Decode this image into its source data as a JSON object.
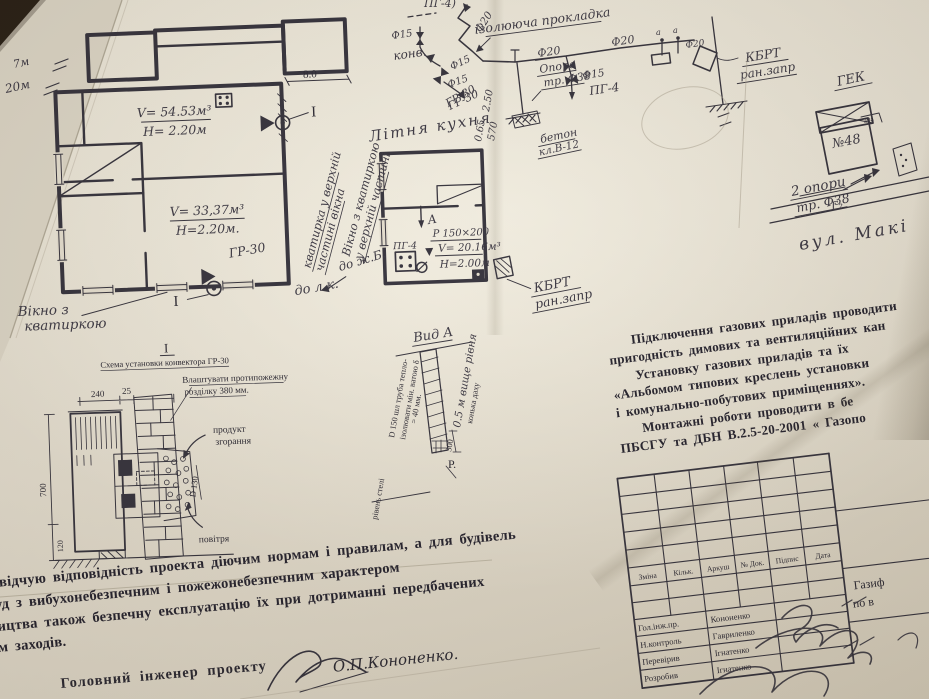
{
  "margin": {
    "note_7m": "7м",
    "note_20m": "20м"
  },
  "floor_plan": {
    "dim_8": "8.0",
    "room1_v": "V= 54.53м³",
    "room1_h": "Н= 2.20м",
    "room2_v": "V= 33,37м³",
    "room2_h": "Н=2.20м.",
    "gr30": "ГР-30",
    "section_right": "I",
    "section_bottom": "I",
    "window_note_1": "Вікно з",
    "window_note_2": "кватиркою",
    "rot_note_1a": "кватирка у верхній",
    "rot_note_1b": "частині вікна",
    "to_lk": "до л.к."
  },
  "kitchen": {
    "title": "Літня кухня",
    "gr30": "ГР-30",
    "rot_note_a": "Вікно з кватиркою",
    "rot_note_b": "у верхній частині",
    "to_zb": "до ж.Б.",
    "pg4": "ПГ-4",
    "view_a": "А",
    "vent": "Р 150×200",
    "vol": "V= 20.16м³",
    "h": "Н=2.00м",
    "kbrt1": "КБРТ",
    "kbrt2": "ран.запр"
  },
  "piping": {
    "pg4_top": "ПГ-4)",
    "f15_a": "Ф15",
    "konv": "конв.",
    "f15_b": "Ф15",
    "f15_c": "Ф15",
    "gr30": "ГР-30",
    "f20_riser": "Ф20",
    "gasket": "ізолююча прокладка",
    "f20_a": "Ф20",
    "f20_b": "Ф20",
    "f20_c": "Ф20",
    "a1": "а",
    "a2": "а",
    "opora1": "Опора",
    "opora2": "тр. Ф38",
    "dim_250": "2.50",
    "dim_065": "0.65",
    "dim_570": "570",
    "beton1": "бетон",
    "beton2": "кл.В-12",
    "f15_d": "Ф15",
    "pg4": "ПГ-4",
    "kbrt1": "КБРТ",
    "kbrt2": "ран.запр"
  },
  "site": {
    "gek": "ГЕК",
    "house": "№48",
    "house_corner": "30а",
    "supports1": "2 опори",
    "supports2": "тр. Ф38",
    "g2": "Г₂",
    "street": "вул. Макі"
  },
  "notes": {
    "l1": "Підключення газових приладів проводити",
    "l2": "пригодність димових та вентиляційних кан",
    "l3": "Установку газових приладів та їх",
    "l4": "«Альбомом типових креслень установки",
    "l5": "і комунально-побутових приміщеннях».",
    "l6": "Монтажні роботи проводити в бе",
    "l7": "ПБСГУ та ДБН В.2.5-20-2001 « Газопо"
  },
  "convector": {
    "mark": "I",
    "title": "Схема установки конвектора ГР-30",
    "note1": "Влаштувати протипожежну",
    "note2": "розділку 380 мм.",
    "dim240": "240",
    "dim25": "25",
    "dim700": "700",
    "dim120": "120",
    "d130": "D 130",
    "prod1": "продукт",
    "prod2": "згорання",
    "air": "повітря"
  },
  "chimney": {
    "title": "Вид А",
    "t1": "D 150 шл труба тепло-",
    "t2": "ізолювати мін. ватою δ",
    "t3": "= 40 мм.",
    "t4": "0.5 м вище рівня",
    "t5": "конька даху",
    "dim300": "300",
    "ceiling": "рівень стелі",
    "r": "Р."
  },
  "certification": {
    "l1": "асвідчую відповідність проекта діючим нормам і правилам, а для будівель",
    "l2": "руд з вибухонебезпечним і пожежонебезпечним характером",
    "l3": "ництва також безпечну експлуатацію їх при дотриманні передбачених",
    "l4": "ом заходів.",
    "engineer": "Головний інженер проекту",
    "name": "О.П.Кононенко."
  },
  "title_block": {
    "col1": "Зміна",
    "col2": "Кільк.",
    "col3": "Аркуш",
    "col4": "№ Док.",
    "col5": "Підпис",
    "col6": "Дата",
    "r1_role": "Гол.інж.пр.",
    "r1_name": "Кононенко",
    "r2_role": "Н.контроль",
    "r2_name": "Гавриленко",
    "r3_role": "Перевірив",
    "r3_name": "Ігнатенко",
    "r4_role": "Розробив",
    "r4_name": "Ігнатенко",
    "doc1": "Газиф",
    "doc2": "по в"
  }
}
